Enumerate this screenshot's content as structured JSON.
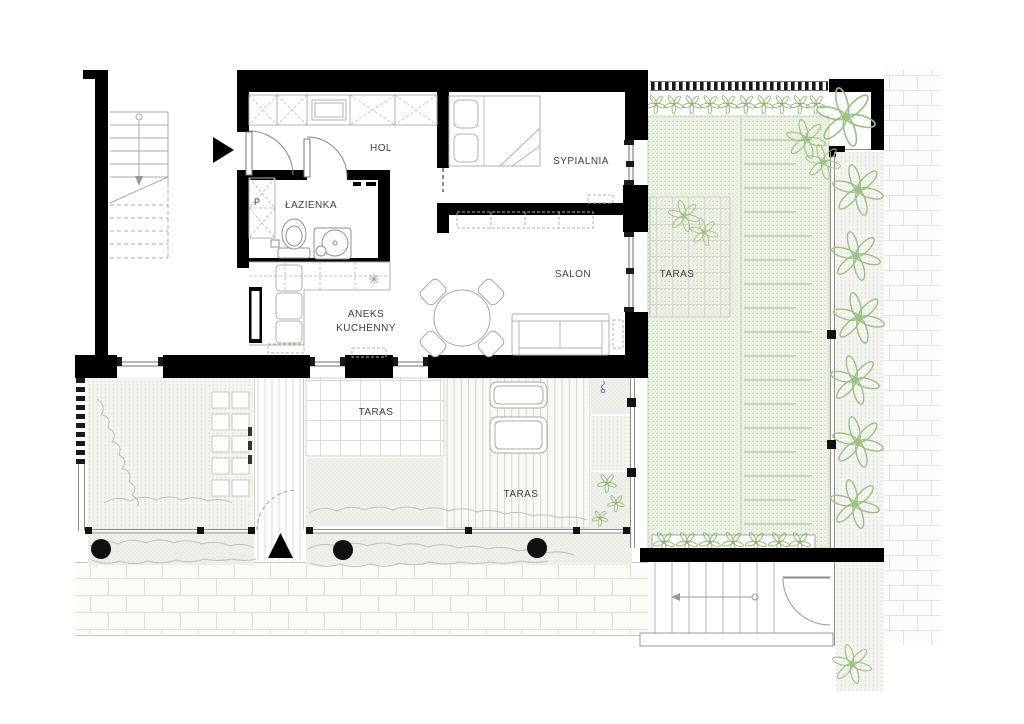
{
  "plan": {
    "type": "apartment floor plan with garden and terraces",
    "language": "pl",
    "rooms": {
      "hol": "HOL",
      "sypialnia": "SYPIALNIA",
      "lazienka": "ŁAZIENKA",
      "salon": "SALON",
      "aneks_kuchenny": [
        "ANEKS",
        "KUCHENNY"
      ],
      "taras_patio": "TARAS",
      "taras_deck": "TARAS",
      "taras_green": "TARAS"
    },
    "markers": {
      "washer_closet": "P"
    },
    "icons": {
      "entrance_main": "filled-triangle-right",
      "entrance_garden": "filled-triangle-up"
    },
    "colors": {
      "wall": "#000000",
      "label": "#3f3f3f",
      "plant_stroke": "#8fb975",
      "green_fill": "#eef3e6",
      "furniture_stroke": "#b0b0aa",
      "paving_stroke": "#dedcd6"
    }
  }
}
